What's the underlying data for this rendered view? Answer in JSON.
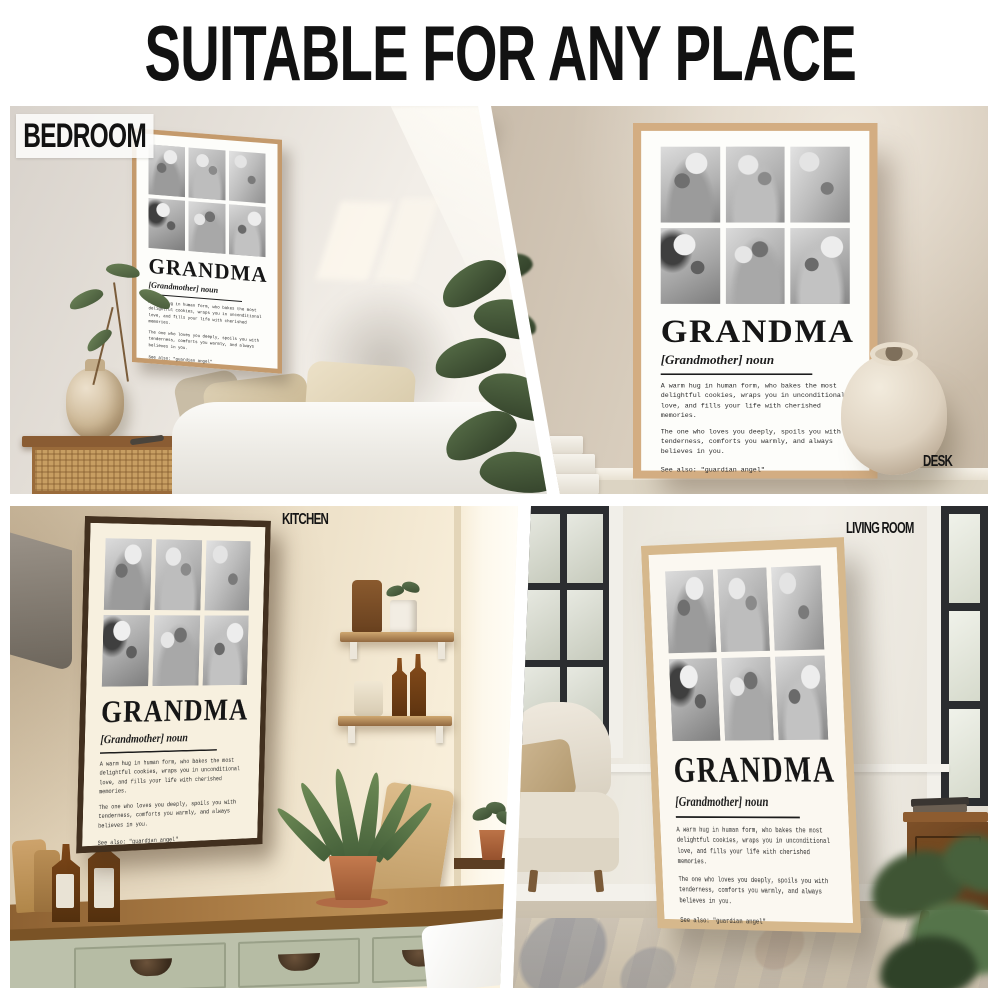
{
  "page": {
    "title": "SUITABLE FOR ANY PLACE",
    "background": "#ffffff"
  },
  "scenes": {
    "bedroom": {
      "label": "BEDROOM",
      "frame_color": "#c49a6c",
      "label_background": "#fcfcfa"
    },
    "desk": {
      "label": "DESK",
      "frame_color": "#d3ad82"
    },
    "kitchen": {
      "label": "KITCHEN",
      "frame_color": "#42301f"
    },
    "living_room": {
      "label": "LIVING ROOM",
      "frame_color": "#d6b88c"
    }
  },
  "poster": {
    "title": "GRANDMA",
    "subtitle": "[Grandmother] noun",
    "definition_1": "A warm hug in human form, who bakes the most delightful cookies, wraps you in unconditional love, and fills your life with cherished memories.",
    "definition_2": "The one who loves you deeply, spoils you with tenderness, comforts you warmly, and always believes in you.",
    "see_also": "See also: \"guardian angel\"",
    "paper_color": "#fdfdfa",
    "photo_style": "black-and-white",
    "photos": [
      {
        "name": "grandma-nuzzling-grandson"
      },
      {
        "name": "grandma-with-granddaughter-on-sofa"
      },
      {
        "name": "grandma-with-glasses-holding-baby"
      },
      {
        "name": "grandma-hugging-granddaughter"
      },
      {
        "name": "grandma-and-grandchildren-selfie"
      },
      {
        "name": "granddaughter-embracing-grandma"
      }
    ]
  },
  "colors": {
    "headline_text": "#121212",
    "bedroom_wall": "#e6e1da",
    "desk_wall": "#d8cdbd",
    "kitchen_wall": "#eee2ca",
    "kitchen_cabinets": "#bcc1ab",
    "kitchen_counter": "#a87a44",
    "living_wall": "#edeae1",
    "window_frame": "#2b2d30"
  }
}
